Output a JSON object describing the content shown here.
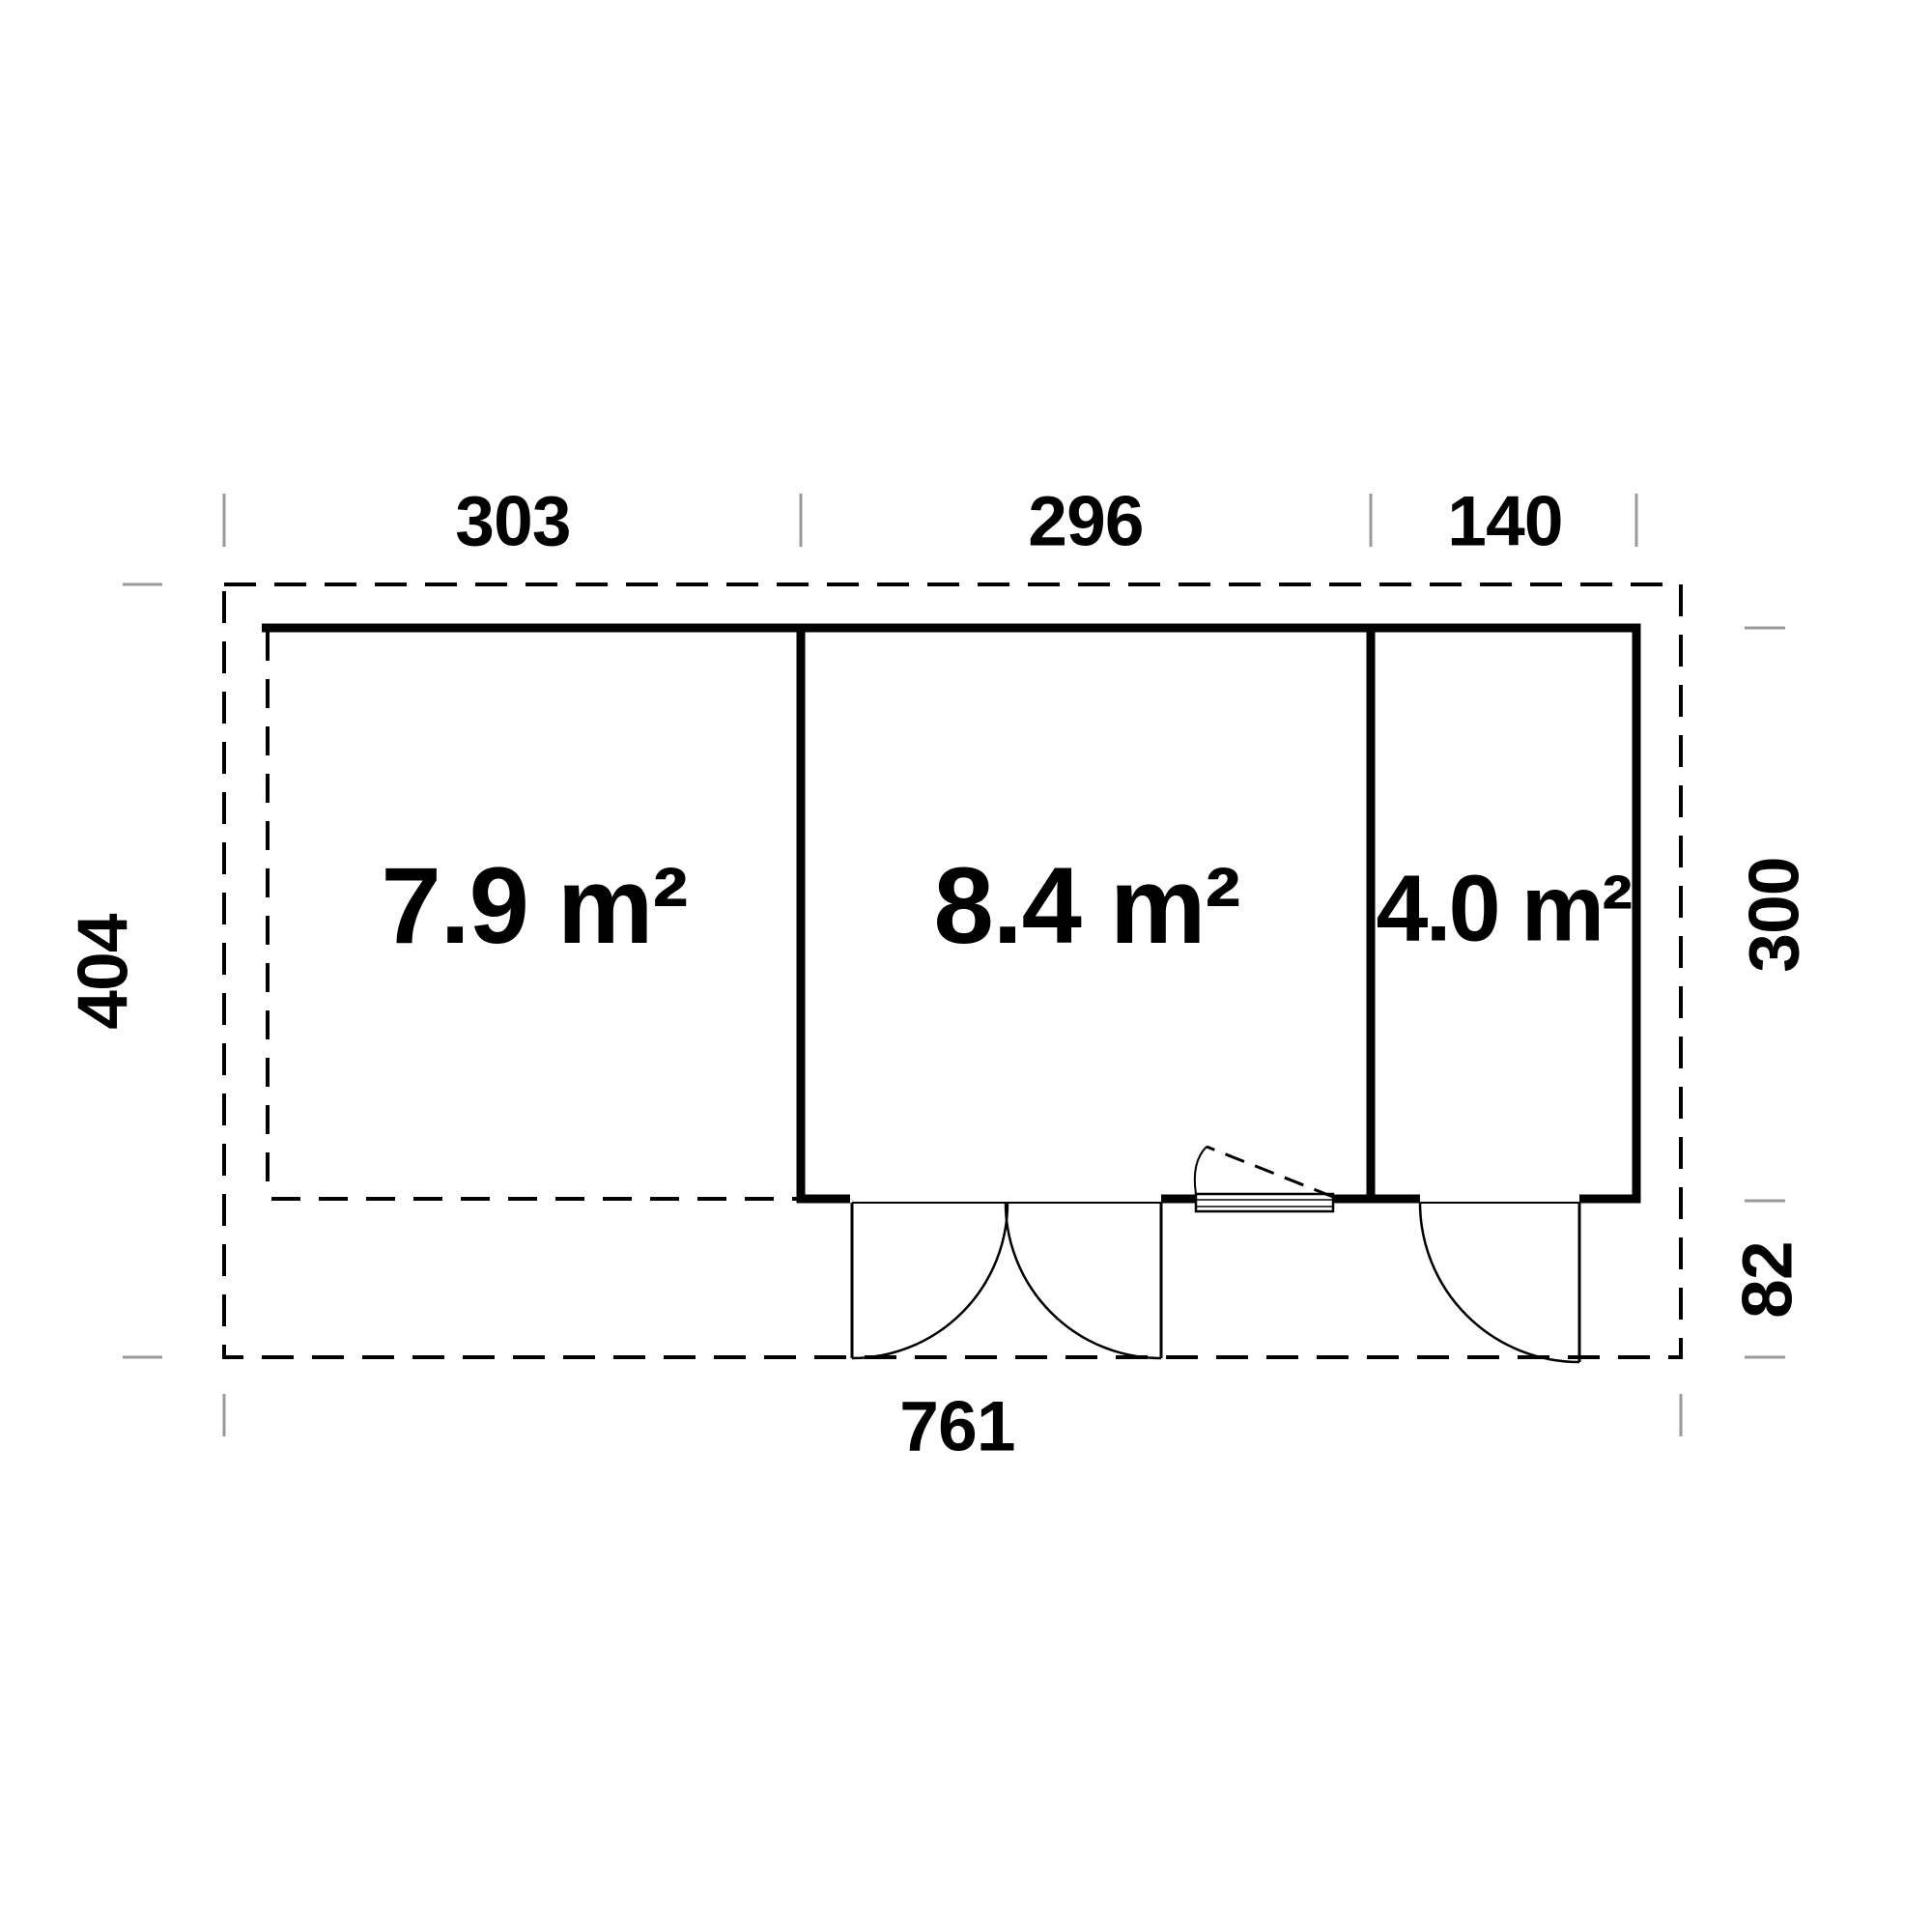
{
  "plan": {
    "unit": "cm",
    "dims": {
      "top_left": "303",
      "top_middle": "296",
      "top_right": "140",
      "bottom_total": "761",
      "left_total": "404",
      "right_main": "300",
      "right_front": "82"
    },
    "rooms": {
      "left_area": "7.9 m²",
      "middle_area": "8.4 m²",
      "right_area": "4.0 m²"
    },
    "colors": {
      "line": "#000000",
      "tick": "#9a9a9a",
      "background": "#ffffff"
    }
  }
}
